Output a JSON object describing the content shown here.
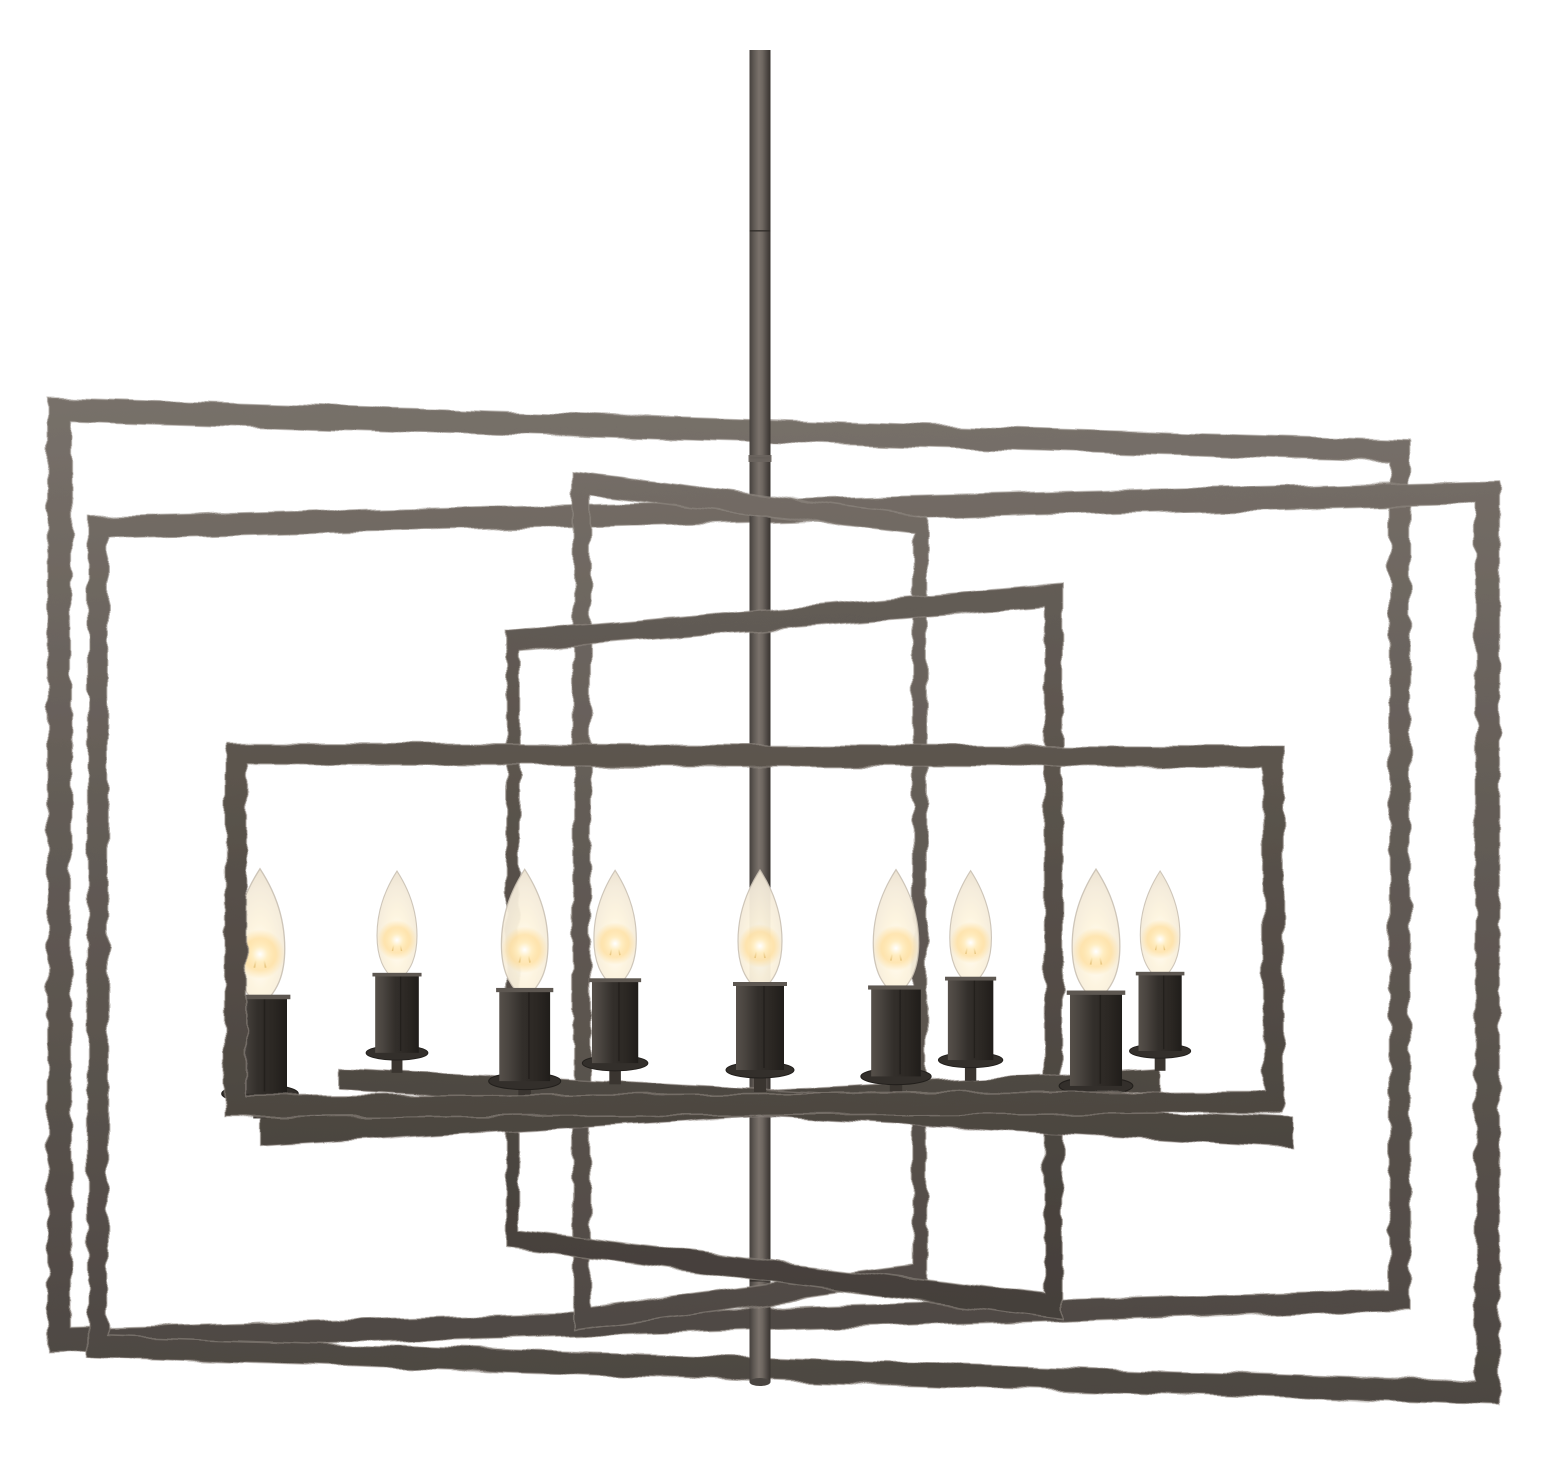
{
  "image": {
    "kind": "product-photo",
    "subject": "nine-light geometric linear chandelier with hammered rectangular metal frames and candelabra bulbs",
    "background_color": "#ffffff",
    "width": 1560,
    "height": 1473,
    "lights_count": 9
  },
  "colors": {
    "metal_light": "#7b746d",
    "metal_mid": "#635c56",
    "metal_dark": "#4c4641",
    "metal_edge_highlight": "#948c85",
    "metal_front_light": "#6e6761",
    "metal_front_mid": "#575049",
    "metal_front_dark": "#403b37",
    "rod_core": "#7a726b",
    "rod_shadow": "#38332f",
    "sleeve_light": "#56504a",
    "sleeve_mid": "#332f2b",
    "sleeve_dark": "#201d1a",
    "saucer": "#332f2b",
    "stem": "#3a3530",
    "bulb_glass_edge": "#e8decb",
    "bulb_glass_core": "#fffef8",
    "bulb_outline": "#c9c0b2",
    "glow_warm": "#ffd98e",
    "filament": "#a97f28"
  },
  "camera": {
    "cx": 760,
    "cy": 880,
    "distance": 2600
  },
  "rod": {
    "x": 760,
    "top": 50,
    "bottom": 1382,
    "width": 21,
    "seams": [
      230,
      457,
      940,
      1280
    ],
    "collar_y": 455,
    "cap_ry": 4
  },
  "frames": [
    {
      "id": "outer-frame-left-forward",
      "rotation_deg": 10,
      "half_width": 690,
      "top": -460,
      "bottom": 450,
      "thickness": 22,
      "seed": 11,
      "tone": "back"
    },
    {
      "id": "outer-frame-right-forward",
      "rotation_deg": -10,
      "half_width": 715,
      "top": -380,
      "bottom": 500,
      "thickness": 22,
      "seed": 23,
      "tone": "back"
    },
    {
      "id": "middle-frame-left-forward",
      "rotation_deg": 40,
      "half_width": 230,
      "top": -385,
      "bottom": 425,
      "thickness": 20,
      "seed": 37,
      "tone": "back"
    },
    {
      "id": "middle-frame-right-forward",
      "rotation_deg": -40,
      "half_width": 360,
      "top": -270,
      "bottom": 400,
      "thickness": 20,
      "seed": 51,
      "tone": "front"
    },
    {
      "id": "inner-front-frame",
      "rotation_deg": 3,
      "half_width": 530,
      "top": -135,
      "bottom": 235,
      "thickness": 21,
      "seed": 67,
      "tone": "front"
    }
  ],
  "arms": [
    {
      "id": "candle-arm-left-forward",
      "rotation_deg": 33,
      "half_width": 530,
      "y": 210,
      "thickness": 26,
      "seed": 73
    },
    {
      "id": "candle-arm-right-forward",
      "rotation_deg": -33,
      "half_width": 560,
      "y": 210,
      "thickness": 26,
      "seed": 89
    }
  ],
  "candles": {
    "count": 9,
    "sizes": {
      "sleeve_w": 48,
      "sleeve_h": 86,
      "flange_w": 54,
      "flange_h": 4,
      "saucer_rx": 34,
      "saucer_ry": 8,
      "stem_w": 12,
      "stem_h": 22,
      "bulb_w": 44,
      "bulb_h": 116
    },
    "placements": [
      {
        "arm": 0,
        "t": -1.0
      },
      {
        "arm": 1,
        "t": -0.85
      },
      {
        "arm": 0,
        "t": -0.5
      },
      {
        "arm": 1,
        "t": -0.32
      },
      {
        "arm": 0,
        "t": 0.0
      },
      {
        "arm": 1,
        "t": 0.28
      },
      {
        "arm": 0,
        "t": 0.5
      },
      {
        "arm": 1,
        "t": 0.66
      },
      {
        "arm": 0,
        "t": 1.0
      }
    ]
  }
}
